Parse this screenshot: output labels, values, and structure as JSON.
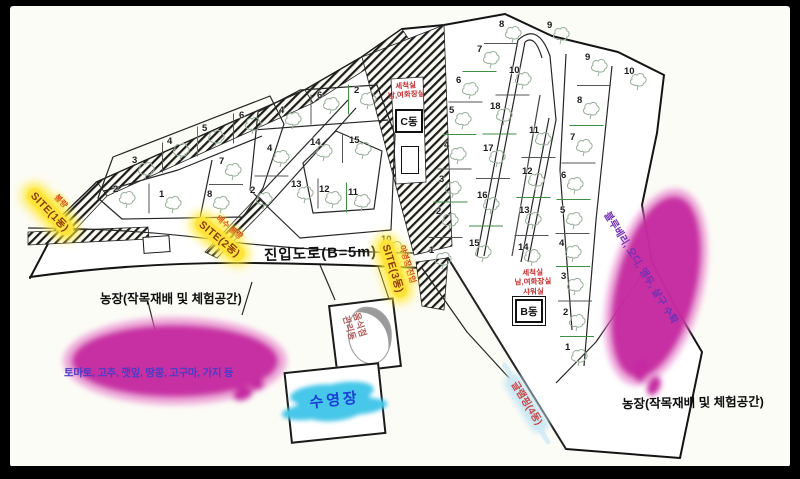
{
  "map": {
    "road_label": "진입도로(B=5m)",
    "farm_label_left": "농장(작목재배 및 체험공간)",
    "farm_label_right": "농장(작목재배 및 체험공간)",
    "left_farm_crops": "토마토, 고추, 깻잎, 땅콩, 고구마, 가지 등",
    "right_farm_crops": "블루베리, 오디, 앵두, 살구 수확",
    "pool_label": "수영장",
    "glamping_label": "글램핑(4동)",
    "building_b": "B동",
    "building_c": "C동",
    "manage_label_1": "음식점",
    "manage_label_2": "관리동",
    "note_c": [
      "세척실",
      "남,여화장실"
    ],
    "note_b": [
      "세척실",
      "남,여화장실",
      "샤워실"
    ],
    "sites": [
      {
        "label": "SITE(1동)",
        "note": "불량"
      },
      {
        "label": "SITE(2동)",
        "note": "배수 불량"
      },
      {
        "label": "SITE(3동)",
        "note": "야영장 진입"
      }
    ],
    "colors": {
      "highlight_yellow": "#ffe33a",
      "farm_pink": "#c52aa0",
      "pool_cyan": "#47c7e9",
      "note_red": "#c23434",
      "crops_blue": "#4a3cc6"
    },
    "plot_groups": [
      {
        "orient": "v",
        "plots": [
          {
            "n": 3,
            "x": 145,
            "y": 167
          },
          {
            "n": 4,
            "x": 180,
            "y": 148
          },
          {
            "n": 5,
            "x": 215,
            "y": 135
          },
          {
            "n": 6,
            "x": 252,
            "y": 122
          }
        ]
      },
      {
        "orient": "v",
        "plots": [
          {
            "n": 2,
            "x": 126,
            "y": 196
          },
          {
            "n": 1,
            "x": 172,
            "y": 201
          }
        ]
      },
      {
        "orient": "h",
        "plots": [
          {
            "n": 7,
            "x": 232,
            "y": 168
          },
          {
            "n": 8,
            "x": 220,
            "y": 201
          }
        ]
      },
      {
        "orient": "v",
        "plots": [
          {
            "n": 4,
            "x": 292,
            "y": 117
          },
          {
            "n": 6,
            "x": 330,
            "y": 102
          },
          {
            "n": 2,
            "x": 367,
            "y": 97
          }
        ]
      },
      {
        "orient": "h",
        "plots": [
          {
            "n": 4,
            "x": 280,
            "y": 155
          },
          {
            "n": 2,
            "x": 263,
            "y": 197
          }
        ]
      },
      {
        "orient": "v",
        "plots": [
          {
            "n": 14,
            "x": 323,
            "y": 149
          },
          {
            "n": 15,
            "x": 362,
            "y": 147
          }
        ]
      },
      {
        "orient": "v",
        "plots": [
          {
            "n": 13,
            "x": 304,
            "y": 191
          },
          {
            "n": 12,
            "x": 332,
            "y": 196
          },
          {
            "n": 11,
            "x": 361,
            "y": 199
          }
        ]
      },
      {
        "orient": "h",
        "plots": [
          {
            "n": 8,
            "x": 512,
            "y": 31
          },
          {
            "n": 7,
            "x": 490,
            "y": 56
          },
          {
            "n": 6,
            "x": 469,
            "y": 87
          },
          {
            "n": 5,
            "x": 462,
            "y": 117
          },
          {
            "n": 4,
            "x": 457,
            "y": 152
          },
          {
            "n": 3,
            "x": 452,
            "y": 186
          },
          {
            "n": 2,
            "x": 449,
            "y": 218
          },
          {
            "n": 1,
            "x": 442,
            "y": 257
          }
        ]
      },
      {
        "orient": "h",
        "plots": [
          {
            "n": 10,
            "x": 522,
            "y": 77
          },
          {
            "n": 18,
            "x": 503,
            "y": 113
          },
          {
            "n": 17,
            "x": 496,
            "y": 155
          },
          {
            "n": 16,
            "x": 490,
            "y": 202
          },
          {
            "n": 15,
            "x": 482,
            "y": 250
          }
        ]
      },
      {
        "orient": "h",
        "plots": [
          {
            "n": 11,
            "x": 542,
            "y": 137
          },
          {
            "n": 12,
            "x": 535,
            "y": 178
          },
          {
            "n": 13,
            "x": 532,
            "y": 217
          },
          {
            "n": 14,
            "x": 531,
            "y": 254
          }
        ]
      },
      {
        "orient": "h",
        "plots": [
          {
            "n": 9,
            "x": 598,
            "y": 64
          },
          {
            "n": 8,
            "x": 590,
            "y": 107
          },
          {
            "n": 7,
            "x": 583,
            "y": 144
          },
          {
            "n": 6,
            "x": 574,
            "y": 182
          },
          {
            "n": 5,
            "x": 573,
            "y": 217
          },
          {
            "n": 4,
            "x": 572,
            "y": 250
          },
          {
            "n": 3,
            "x": 574,
            "y": 283
          },
          {
            "n": 2,
            "x": 576,
            "y": 319
          },
          {
            "n": 1,
            "x": 578,
            "y": 354
          }
        ]
      },
      {
        "orient": "h",
        "plots": [
          {
            "n": 9,
            "x": 560,
            "y": 32
          }
        ]
      },
      {
        "orient": "h",
        "plots": [
          {
            "n": 10,
            "x": 637,
            "y": 78
          }
        ]
      },
      {
        "orient": "h",
        "plots": [
          {
            "n": 10,
            "x": 394,
            "y": 246
          }
        ]
      }
    ]
  }
}
